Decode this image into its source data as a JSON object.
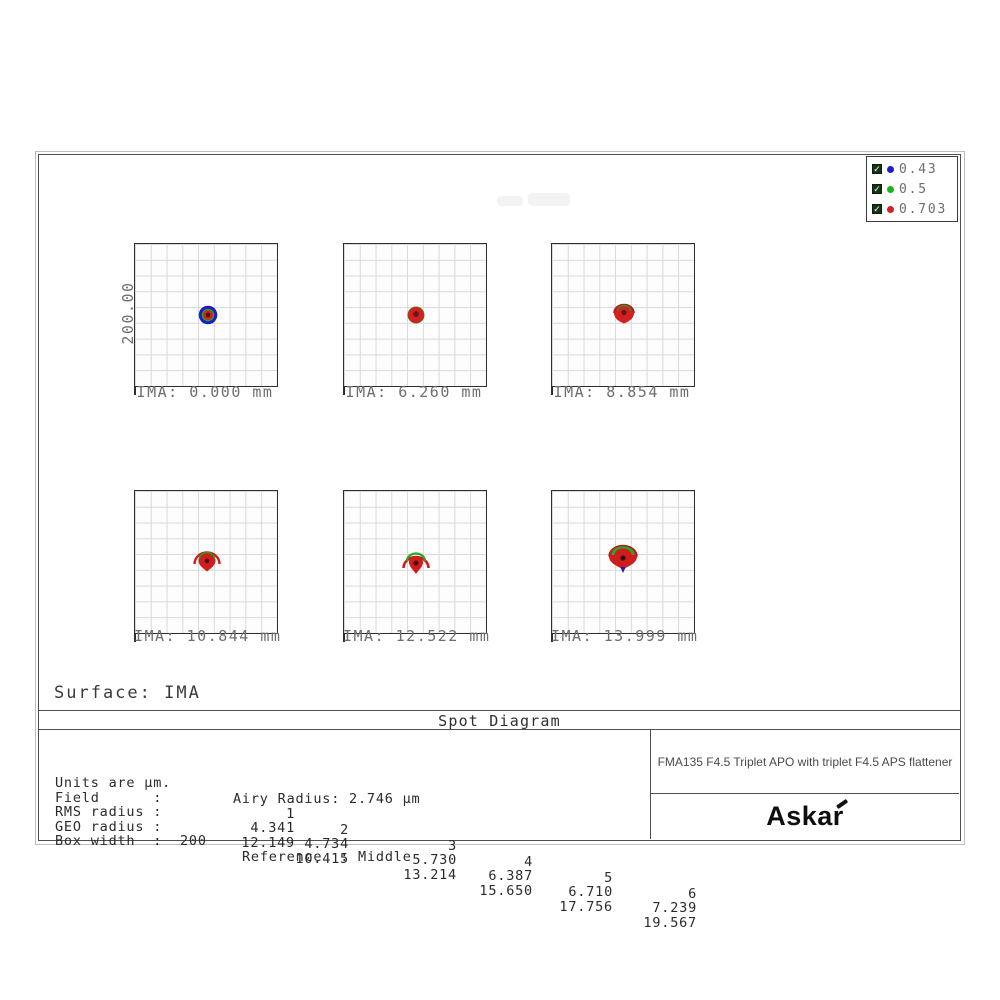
{
  "legend": {
    "items": [
      {
        "label": "0.43",
        "color": "#1c1ccd"
      },
      {
        "label": "0.5",
        "color": "#18b418"
      },
      {
        "label": "0.703",
        "color": "#d42020"
      }
    ]
  },
  "axis": {
    "y_scale_label": "200.00"
  },
  "grids": [
    {
      "label": "IMA: 0.000 mm"
    },
    {
      "label": "IMA: 6.260 mm"
    },
    {
      "label": "IMA: 8.854 mm"
    },
    {
      "label": "IMA: 10.844 mm"
    },
    {
      "label": "IMA: 12.522 mm"
    },
    {
      "label": "IMA: 13.999 mm"
    }
  ],
  "surface_label": "Surface: IMA",
  "title": "Spot Diagram",
  "stats": {
    "units_label": "Units are µm.",
    "airy_label": "Airy Radius: 2.746 µm",
    "field_label": "Field      :",
    "rms_label": "RMS radius :",
    "geo_label": "GEO radius :",
    "field_values": [
      "1",
      "2",
      "3",
      "4",
      "5",
      "6"
    ],
    "rms_values": [
      "4.341",
      "4.734",
      "5.730",
      "6.387",
      "6.710",
      "7.239"
    ],
    "geo_values": [
      "12.149",
      "10.415",
      "13.214",
      "15.650",
      "17.756",
      "19.567"
    ],
    "box_width_label": "Box width  :  200",
    "reference_label": "Reference  : Middle"
  },
  "titleblock": {
    "description": "FMA135 F4.5 Triplet APO with triplet F4.5 APS flattener",
    "brand": "Askar"
  },
  "chart_data": {
    "type": "scatter",
    "title": "Spot Diagram",
    "subtitle": "Surface: IMA",
    "wavelengths_um": [
      0.43,
      0.5,
      0.703
    ],
    "wavelength_colors": [
      "blue",
      "green",
      "red"
    ],
    "airy_radius_um": 2.746,
    "box_width_um": 200,
    "reference": "Middle",
    "y_scale_label": "200.00",
    "panels": [
      {
        "field": 1,
        "ima_mm": 0.0,
        "rms_radius_um": 4.341,
        "geo_radius_um": 12.149
      },
      {
        "field": 2,
        "ima_mm": 6.26,
        "rms_radius_um": 4.734,
        "geo_radius_um": 10.415
      },
      {
        "field": 3,
        "ima_mm": 8.854,
        "rms_radius_um": 5.73,
        "geo_radius_um": 13.214
      },
      {
        "field": 4,
        "ima_mm": 10.844,
        "rms_radius_um": 6.387,
        "geo_radius_um": 15.65
      },
      {
        "field": 5,
        "ima_mm": 12.522,
        "rms_radius_um": 6.71,
        "geo_radius_um": 17.756
      },
      {
        "field": 6,
        "ima_mm": 13.999,
        "rms_radius_um": 7.239,
        "geo_radius_um": 19.567
      }
    ],
    "layout": {
      "grid_rows": 2,
      "grid_cols": 3,
      "gridlines_per_box": 9,
      "legend_position": "top-right"
    }
  }
}
